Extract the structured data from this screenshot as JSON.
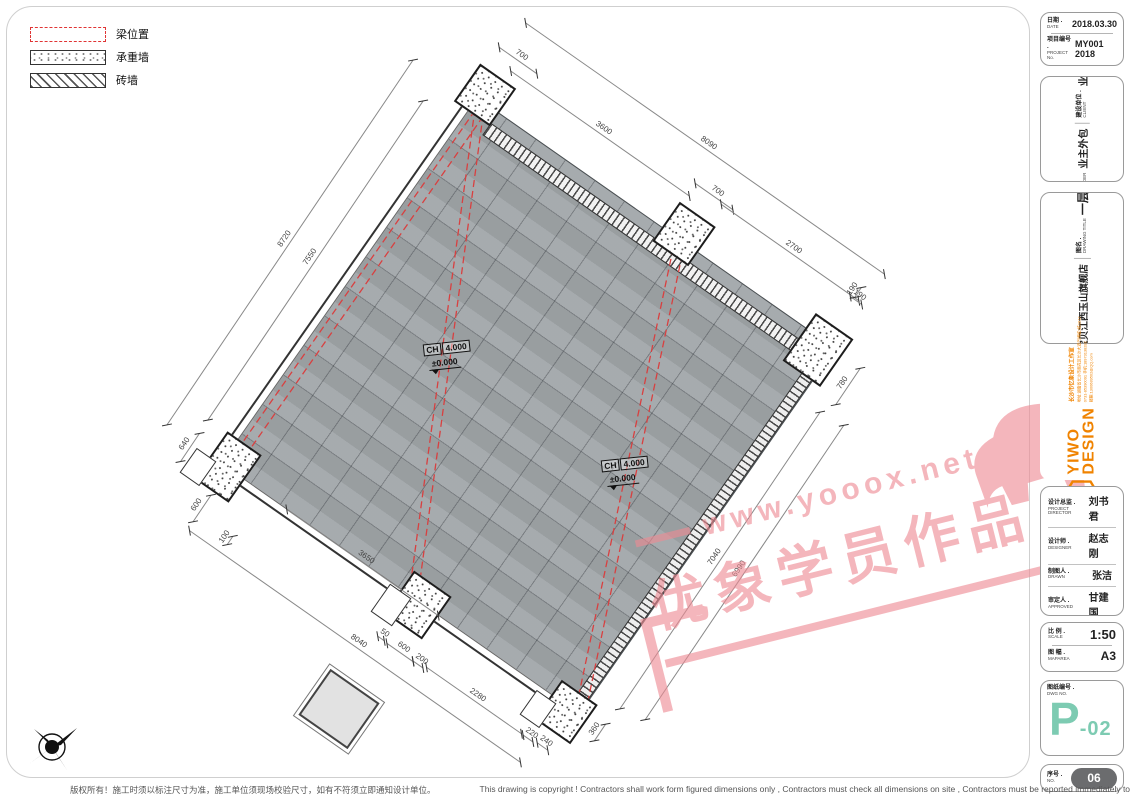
{
  "legend": {
    "items": [
      {
        "label": "梁位置",
        "type": "beam"
      },
      {
        "label": "承重墙",
        "type": "bearing-wall"
      },
      {
        "label": "砖墙",
        "type": "brick-wall"
      }
    ]
  },
  "plan": {
    "labels": [
      {
        "tag": "CH",
        "height": "4.000",
        "level": "±0.000"
      },
      {
        "tag": "CH",
        "height": "4.000",
        "level": "±0.000"
      }
    ],
    "dims": [
      {
        "label": "700",
        "cx": 518,
        "cy": 60,
        "len": 46,
        "angle": 35
      },
      {
        "label": "3600",
        "cx": 600,
        "cy": 133,
        "len": 218,
        "angle": 35
      },
      {
        "label": "8090",
        "cx": 705,
        "cy": 148,
        "len": 438,
        "angle": 35
      },
      {
        "label": "700",
        "cx": 714,
        "cy": 196,
        "len": 46,
        "angle": 35
      },
      {
        "label": "2700",
        "cx": 790,
        "cy": 252,
        "len": 168,
        "angle": 35
      },
      {
        "label": "190",
        "cx": 856,
        "cy": 300,
        "len": 14,
        "angle": 35
      },
      {
        "label": "8720",
        "cx": 290,
        "cy": 242,
        "len": 440,
        "angle": -56
      },
      {
        "label": "7550",
        "cx": 315,
        "cy": 260,
        "len": 385,
        "angle": -56
      },
      {
        "label": "640",
        "cx": 190,
        "cy": 447,
        "len": 34,
        "angle": -56
      },
      {
        "label": "600",
        "cx": 202,
        "cy": 508,
        "len": 32,
        "angle": -56
      },
      {
        "label": "100",
        "cx": 230,
        "cy": 540,
        "len": 10,
        "angle": -56
      },
      {
        "label": "3650",
        "cx": 362,
        "cy": 562,
        "len": 185,
        "angle": 35
      },
      {
        "label": "8040",
        "cx": 355,
        "cy": 646,
        "len": 404,
        "angle": 35
      },
      {
        "label": "50",
        "cx": 381,
        "cy": 638,
        "len": 8,
        "angle": 35
      },
      {
        "label": "600",
        "cx": 400,
        "cy": 652,
        "len": 32,
        "angle": 35
      },
      {
        "label": "200",
        "cx": 418,
        "cy": 664,
        "len": 12,
        "angle": 35
      },
      {
        "label": "2280",
        "cx": 474,
        "cy": 700,
        "len": 116,
        "angle": 35
      },
      {
        "label": "220",
        "cx": 528,
        "cy": 738,
        "len": 12,
        "angle": 35
      },
      {
        "label": "240",
        "cx": 542,
        "cy": 746,
        "len": 13,
        "angle": 35
      },
      {
        "label": "360",
        "cx": 600,
        "cy": 732,
        "len": 20,
        "angle": -56
      },
      {
        "label": "190",
        "cx": 858,
        "cy": 292,
        "len": 12,
        "angle": -56
      },
      {
        "label": "780",
        "cx": 848,
        "cy": 386,
        "len": 44,
        "angle": -56
      },
      {
        "label": "7040",
        "cx": 720,
        "cy": 560,
        "len": 358,
        "angle": -56
      },
      {
        "label": "6990",
        "cx": 744,
        "cy": 572,
        "len": 355,
        "angle": -56
      }
    ]
  },
  "titleblock": {
    "date_label": "日期 .",
    "date_label_en": "DATE",
    "date_value": "2018.03.30",
    "project_no_label": "项目编号 .",
    "project_no_label_en": "PROJECT No.",
    "project_no_value": "MY001 2018",
    "leader_label": "工程负责",
    "leader_label_en": "PROJECT LEADER",
    "leader_value": "业主外包",
    "client_label": "建设单位 .",
    "client_label_en": "CLIENT",
    "client_value": "业主外包",
    "title_label": "项目名称 .",
    "title_label_en": "PROJECT TITLE",
    "title_value": "一班宝贝江西玉山旗舰店",
    "drawing_label": "图名 .",
    "drawing_label_en": "DRAWING TITLE",
    "drawing_value": "一层原始结构图",
    "director_label": "设计总监 .",
    "director_label_en": "PROJECT DIRECTOR",
    "director_value": "刘书君",
    "designer_label": "设计师 .",
    "designer_label_en": "DESIGNER",
    "designer_value": "赵志刚",
    "drawn_label": "制图人 .",
    "drawn_label_en": "DRAWN",
    "drawn_value": "张洁",
    "approved_label": "审定人 .",
    "approved_label_en": "APPROVED",
    "approved_value": "甘建国",
    "client_sign_label": "客户签名 .",
    "client_sign_label_en": "CLIENT SIGN",
    "client_sign_value": "",
    "scale_label": "比 例 .",
    "scale_label_en": "SCALE",
    "scale_value": "1:50",
    "size_label": "图 幅 .",
    "size_label_en": "MAPAREA",
    "size_value": "A3",
    "dwg_label": "图纸编号 .",
    "dwg_label_en": "DWG NO.",
    "dwg_value_main": "P",
    "dwg_value_suffix": "-02",
    "no_label": "序号 .",
    "no_label_en": "NO.",
    "no_value": "06"
  },
  "logo": {
    "brand_line1": "YIWO",
    "brand_line2": "DESIGN",
    "lines": [
      "长沙市忆象设计工作室",
      "地址:湖南省长沙市雨花区长沙大道汽博城1栋1812",
      "0731-85390091 手机:18973138282",
      "邮箱:1300689502@QQ.com"
    ]
  },
  "watermark": {
    "line1": "www.yooox.net",
    "line2": "优象学员作品"
  },
  "footer": {
    "zh": "版权所有！施工时须以标注尺寸为准，施工单位须现场校验尺寸，如有不符须立即通知设计单位。",
    "en": "This drawing is copyright ! Contractors shall work form figured dimensions only , Contractors must check all dimensions on site , Contractors must be reported immediately to architects ."
  },
  "colors": {
    "dwg_no": "#7dcbb2",
    "beam_red": "#d84040",
    "logo_orange": "#f08300",
    "watermark_pink": "#ee8b94",
    "pill_gray": "#6b6c6e",
    "plan_fill": "#a1a6a9"
  }
}
